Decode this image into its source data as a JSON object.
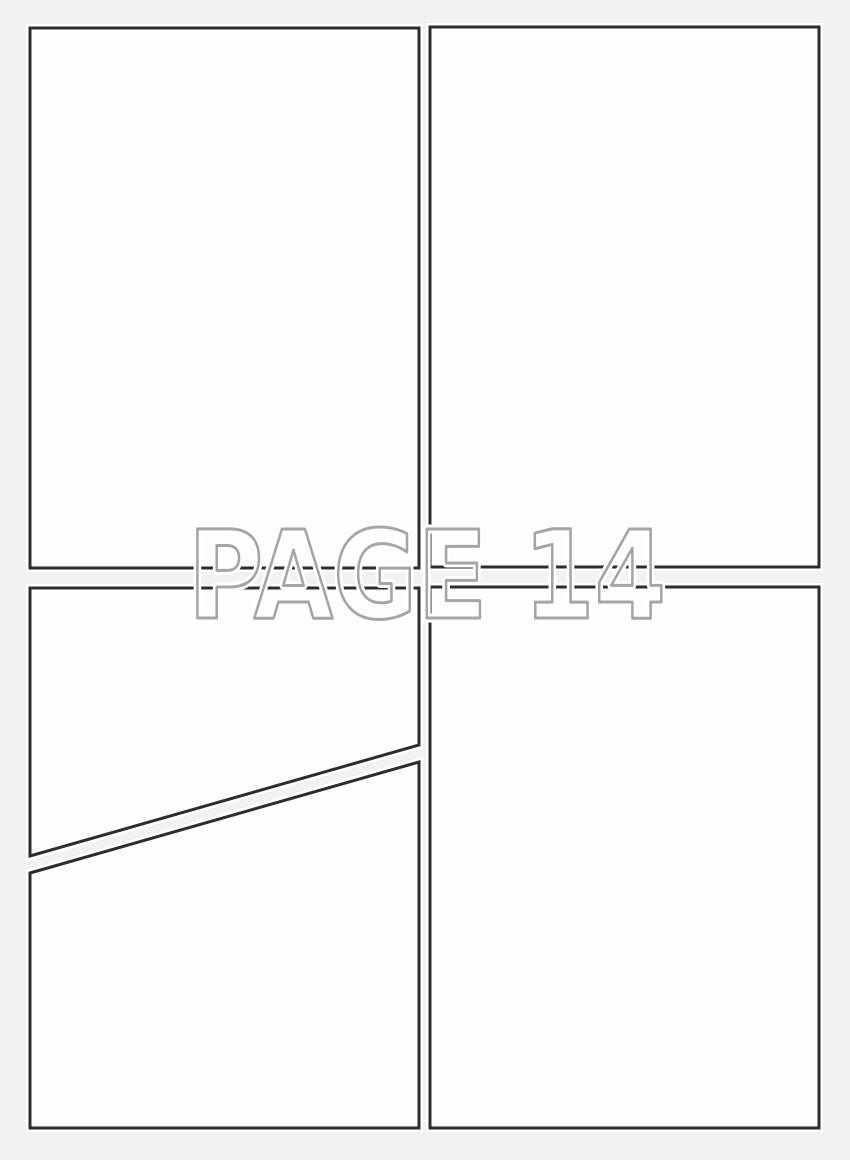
{
  "canvas": {
    "background_color": "#f2f2f2",
    "panel_fill": "#fdfdfd",
    "panel_border_color": "#2d2d2d",
    "panel_outer_glow": "#ffffff"
  },
  "watermark": {
    "text": "PAGE 14",
    "outline_color": "#a5a5a5",
    "halo_color": "#ffffff"
  }
}
